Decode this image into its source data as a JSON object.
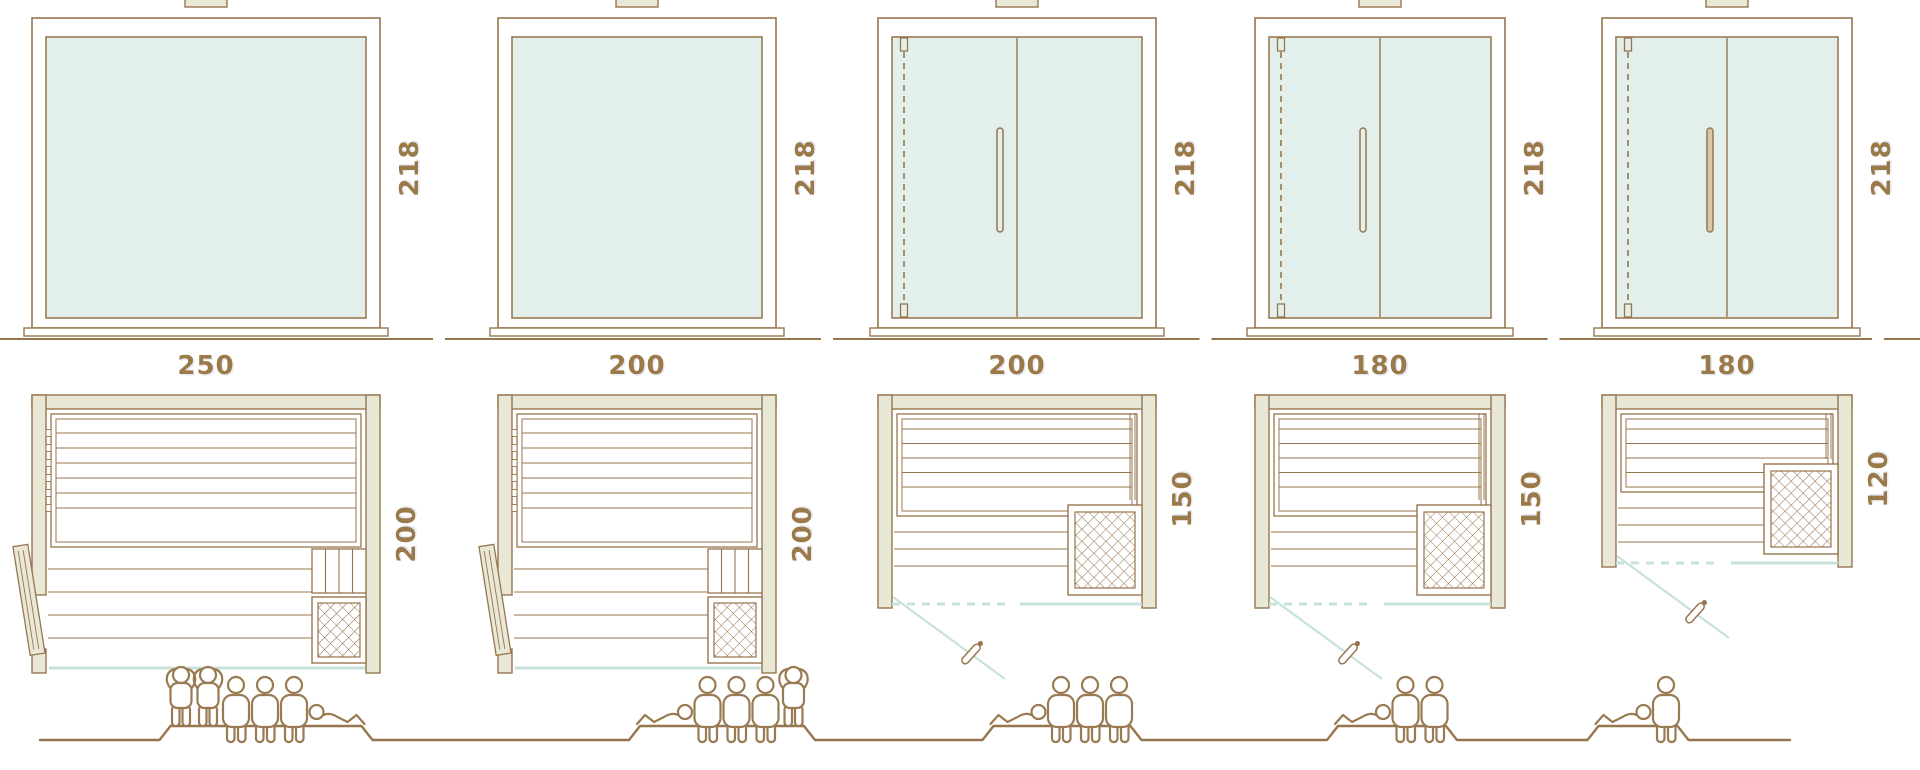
{
  "diagram_title": "sauna-size-comparison",
  "colors": {
    "outline": "#96764e",
    "wood_fill": "#e9e8d6",
    "glass_fill": "#e3efeb",
    "glass_edge": "#9a7a52",
    "teal_line": "#c7e2db",
    "dim_text": "#9b7a4a",
    "people": "#9a7a52",
    "handle_fill": "#d8c9ab",
    "white": "#ffffff"
  },
  "units": [
    {
      "name": "sauna-250x200",
      "width_label": "250",
      "height_label": "218",
      "depth_label": "200",
      "width_cm": 250,
      "height_cm": 218,
      "depth_cm": 200,
      "front_type": "fixed-panel",
      "plan_door": "side-swing-left",
      "heater_position": "bottom-right",
      "capacity": 6,
      "figures": [
        "standing",
        "standing",
        "seated",
        "seated",
        "seated",
        "lying-head-left"
      ]
    },
    {
      "name": "sauna-200x200",
      "width_label": "200",
      "height_label": "218",
      "depth_label": "200",
      "width_cm": 200,
      "height_cm": 218,
      "depth_cm": 200,
      "front_type": "fixed-panel",
      "plan_door": "side-swing-left",
      "heater_position": "bottom-right",
      "capacity": 5,
      "figures": [
        "lying",
        "seated",
        "seated",
        "seated",
        "standing"
      ]
    },
    {
      "name": "sauna-200x150",
      "width_label": "200",
      "height_label": "218",
      "depth_label": "150",
      "width_cm": 200,
      "height_cm": 218,
      "depth_cm": 150,
      "front_type": "hinged-double-door",
      "plan_door": "front-swing-left",
      "heater_position": "bottom-right",
      "capacity": 4,
      "figures": [
        "lying",
        "seated",
        "seated",
        "seated"
      ]
    },
    {
      "name": "sauna-180x150",
      "width_label": "180",
      "height_label": "218",
      "depth_label": "150",
      "width_cm": 180,
      "height_cm": 218,
      "depth_cm": 150,
      "front_type": "hinged-double-door",
      "plan_door": "front-swing-left",
      "heater_position": "bottom-right",
      "capacity": 3,
      "figures": [
        "lying",
        "seated",
        "seated"
      ]
    },
    {
      "name": "sauna-180x120",
      "width_label": "180",
      "height_label": "218",
      "depth_label": "120",
      "width_cm": 180,
      "height_cm": 218,
      "depth_cm": 120,
      "front_type": "hinged-double-door",
      "plan_door": "front-swing-left",
      "heater_position": "bottom-right",
      "capacity": 2,
      "figures": [
        "lying",
        "seated"
      ]
    }
  ]
}
